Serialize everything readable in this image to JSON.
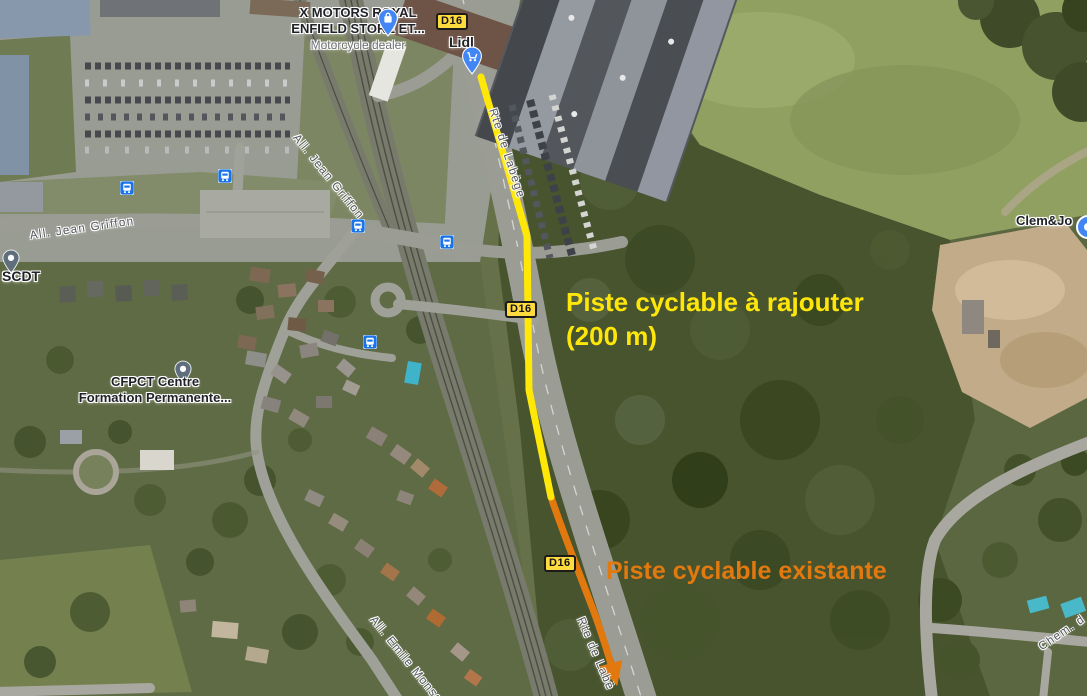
{
  "map_type": "satellite",
  "annotations": {
    "to_add": {
      "line1": "Piste cyclable à rajouter",
      "line2": "(200 m)",
      "color": "#ffe60a"
    },
    "existing": {
      "label": "Piste cyclable existante",
      "color": "#e2790f"
    }
  },
  "badges": {
    "d16": "D16"
  },
  "pois": {
    "x_motors": {
      "line1": "X MOTORS ROYAL",
      "line2": "ENFIELD STORE ET...",
      "subtitle": "Motorcycle dealer",
      "icon": "shopping-bag-pin-icon"
    },
    "lidl": {
      "name": "Lidl",
      "icon": "shopping-cart-pin-icon"
    },
    "scdt": {
      "name": "SCDT",
      "icon": "place-pin-icon"
    },
    "cfpct": {
      "line1": "CFPCT Centre",
      "line2": "Formation Permanente...",
      "icon": "place-pin-icon"
    },
    "clem_jo": {
      "name": "Clem&Jo",
      "icon": "place-pin-icon"
    }
  },
  "streets": {
    "jean_griffon": "All. Jean Griffon",
    "jean_griffon_2": "All. Jean Griffon",
    "rte_de_labege": "Rte de Labège",
    "rte_de_labege_2": "Rte de Labè",
    "emile_monso": "All. Emile Monso",
    "chemin": "Chem. d"
  },
  "transit": {
    "stop_icon": "bus-icon",
    "stop_count": 5
  },
  "colors": {
    "route_line_new": "#ffe808",
    "route_line_existing": "#e2790f",
    "badge_bg": "#ffdb3d",
    "transit_blue": "#1a73e8",
    "pin_blue": "#4285f4"
  }
}
